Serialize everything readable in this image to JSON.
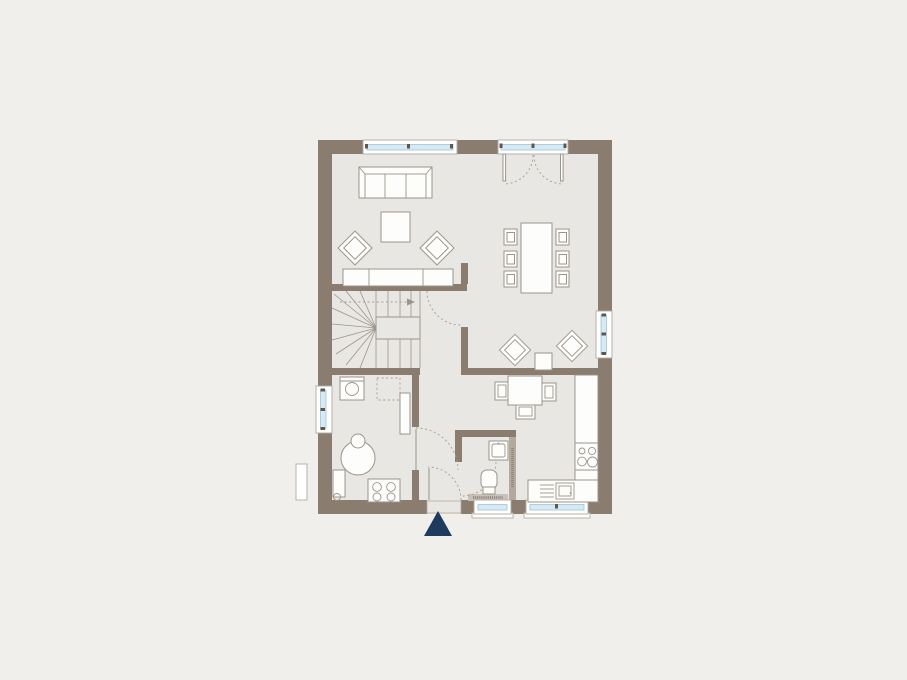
{
  "document": {
    "kind": "architectural floor plan, ground floor, top-down view",
    "visible_text": "",
    "annotations_note": "illegible micro-text on wc installation wall and threshold band"
  },
  "palette": {
    "background": "#f0efec",
    "floor": "#e9e7e3",
    "wall": "#8a7c6e",
    "outline": "#9c948a",
    "frame": "#b3aba2",
    "glazing": "#d7e9f2",
    "glazing_edge": "#9cc4d8",
    "mullion": "#5f574e",
    "dash": "#a59d94",
    "hatch": "#b2a99f",
    "band": "#c9c0b7",
    "marks": "#8a8178",
    "north_arrow": "#1e3a5e"
  },
  "elements": {
    "windows": [
      {
        "id": "living-window",
        "wall": "north"
      },
      {
        "id": "dining-window",
        "wall": "east"
      },
      {
        "id": "utility-window",
        "wall": "west"
      },
      {
        "id": "wc-window",
        "wall": "south"
      },
      {
        "id": "kitchen-window",
        "wall": "south"
      }
    ],
    "doors": [
      {
        "id": "terrace-french-door",
        "wall": "north",
        "type": "double-swing"
      },
      {
        "id": "entrance-door",
        "wall": "south",
        "type": "swing"
      },
      {
        "id": "living-hall-door",
        "type": "swing"
      },
      {
        "id": "utility-hall-door",
        "type": "swing"
      },
      {
        "id": "wc-door",
        "type": "swing"
      }
    ],
    "north_arrow": {
      "shape": "solid-triangle",
      "direction": "up"
    }
  },
  "rooms": [
    {
      "id": "living-area",
      "furniture": [
        "three-seat-sofa",
        "coffee-table",
        "armchair",
        "armchair",
        "sideboard"
      ]
    },
    {
      "id": "dining-area",
      "furniture": [
        "dining-table",
        "dining-chair-x6"
      ]
    },
    {
      "id": "lounge-corner",
      "furniture": [
        "armchair",
        "armchair",
        "side-table"
      ]
    },
    {
      "id": "kitchen",
      "furniture": [
        "breakfast-table",
        "chair-x3",
        "tall-cabinet-counter",
        "cooktop-4-burner",
        "sink-with-drainer"
      ]
    },
    {
      "id": "wc",
      "furniture": [
        "washbasin",
        "toilet",
        "installation-wall"
      ]
    },
    {
      "id": "utility-room",
      "furniture": [
        "washing-machine",
        "appliance-space-dashed",
        "side-counter",
        "boiler-tank",
        "radiator",
        "stove-4-ring"
      ]
    },
    {
      "id": "stair-hall",
      "furniture": [
        "winder-staircase"
      ]
    }
  ]
}
